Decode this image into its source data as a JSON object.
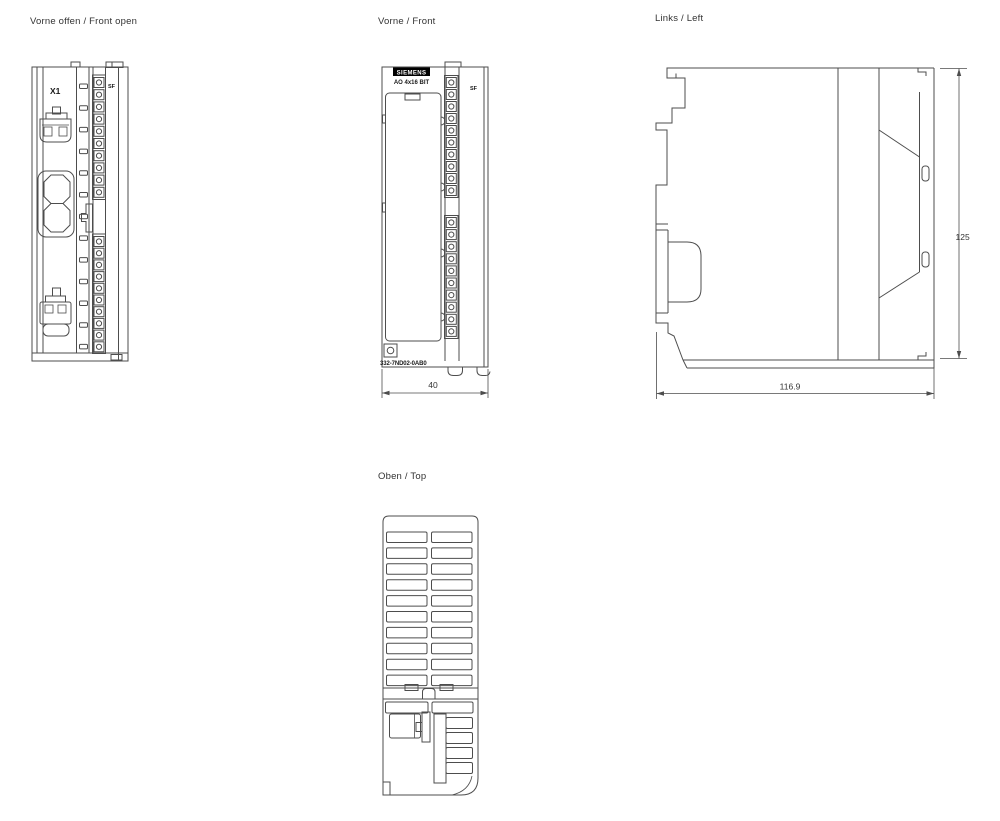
{
  "page": {
    "background": "#ffffff"
  },
  "colors": {
    "line": "#4d4d4d",
    "text": "#333333",
    "logo_bg": "#000000",
    "logo_text": "#ffffff"
  },
  "views": {
    "front_open": {
      "title": "Vorne offen / Front open",
      "connector_label": "X1",
      "led_label": "SF"
    },
    "front": {
      "title": "Vorne / Front",
      "brand": "SIEMENS",
      "module_label": "AO 4x16 BIT",
      "led_label": "SF",
      "part_number": "332-7ND02-0AB0",
      "dim_width_mm": "40"
    },
    "left": {
      "title": "Links / Left",
      "dim_height_mm": "125",
      "dim_depth_mm": "116.9"
    },
    "top": {
      "title": "Oben / Top"
    }
  }
}
